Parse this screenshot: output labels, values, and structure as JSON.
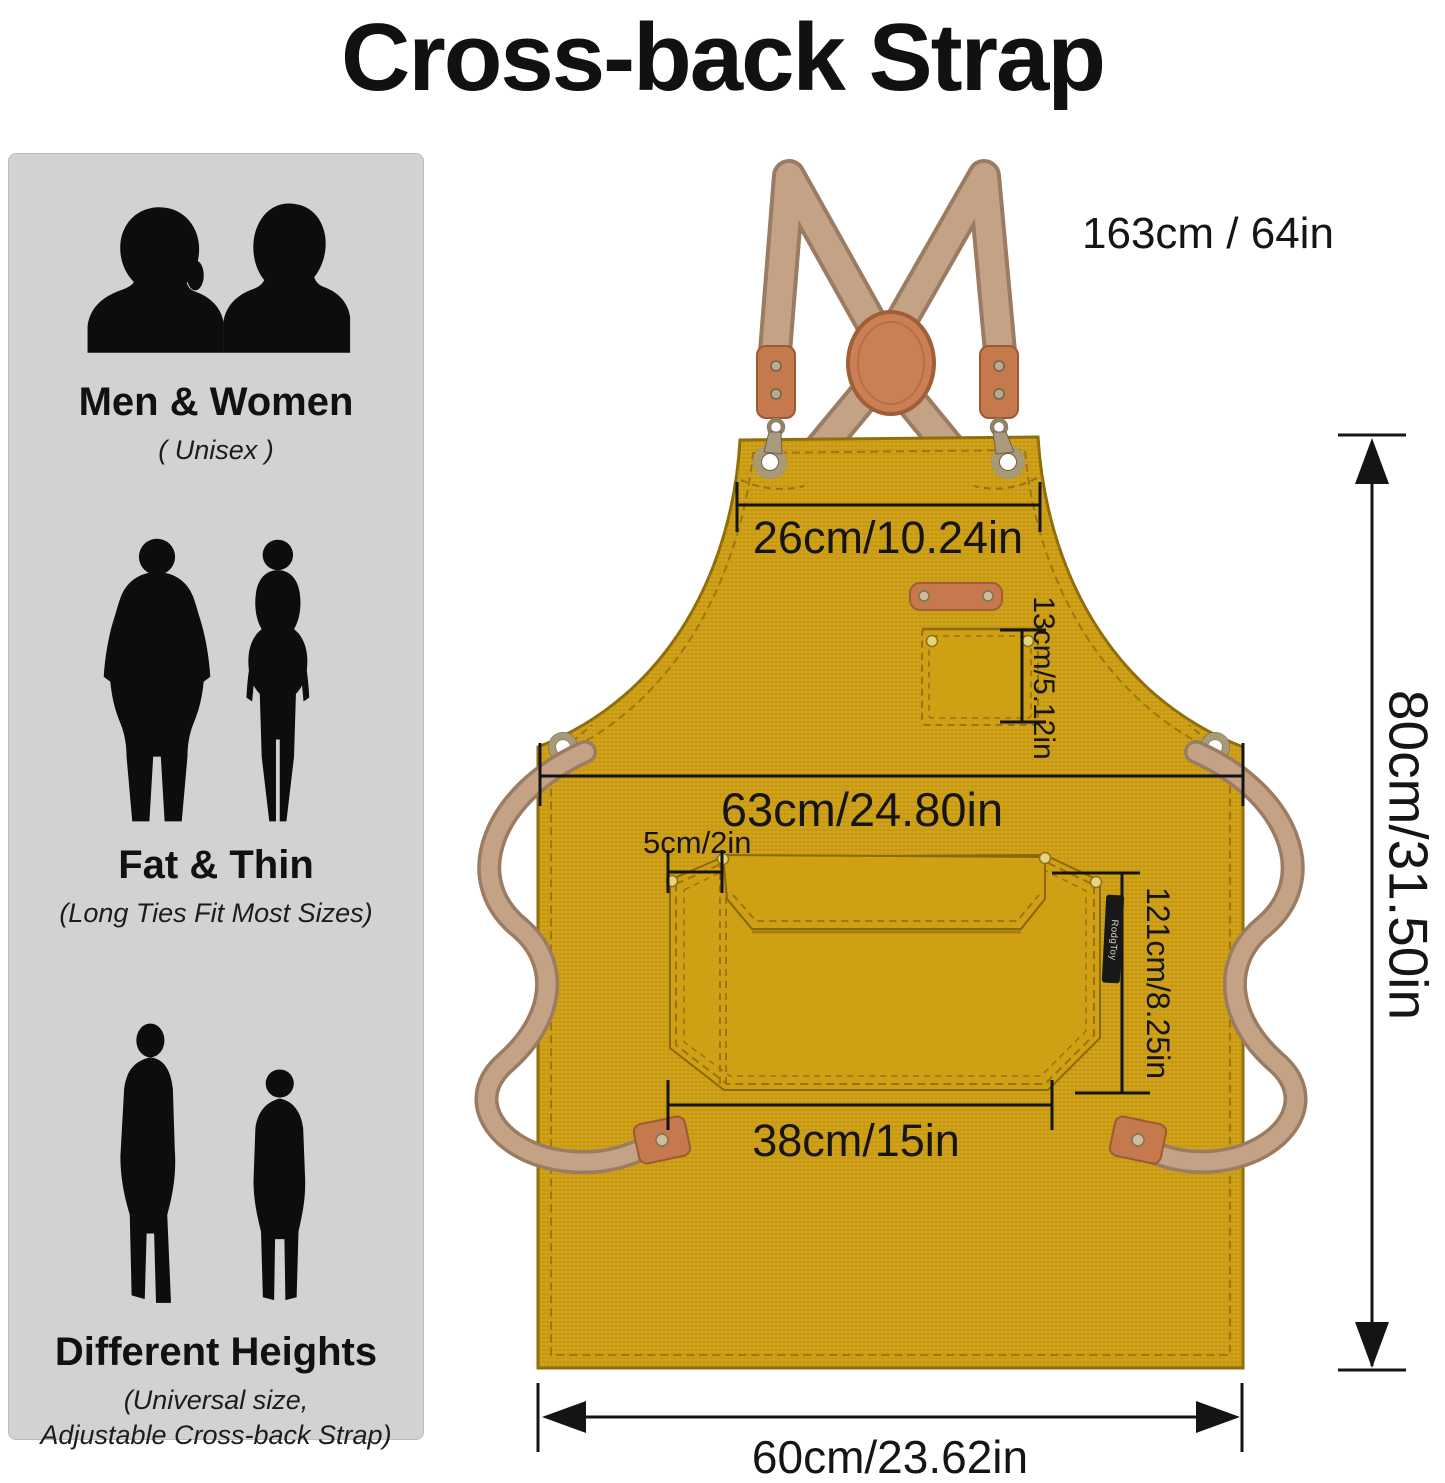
{
  "title": "Cross-back Strap",
  "sidebar": {
    "sections": [
      {
        "title": "Men & Women",
        "lines": [
          "( Unisex )"
        ]
      },
      {
        "title": "Fat & Thin",
        "lines": [
          "(Long Ties Fit Most Sizes)"
        ]
      },
      {
        "title": "Different Heights",
        "lines": [
          "(Universal size,",
          "Adjustable Cross-back Strap)"
        ]
      }
    ]
  },
  "apron": {
    "brand_tag": "RodgToy",
    "measurements": {
      "strap_length": "163cm / 64in",
      "bib_top_width": "26cm/10.24in",
      "chest_pocket_height": "13cm/5.12in",
      "waist_width": "63cm/24.80in",
      "pocket_slot_width": "5cm/2in",
      "front_pocket_height": "121cm/8.25in",
      "front_pocket_width": "38cm/15in",
      "apron_height": "80cm/31.50in",
      "bottom_width": "60cm/23.62in"
    },
    "colors": {
      "fabric": "#cfa013",
      "strap": "#c4a285",
      "leather": "#c5794d"
    }
  }
}
